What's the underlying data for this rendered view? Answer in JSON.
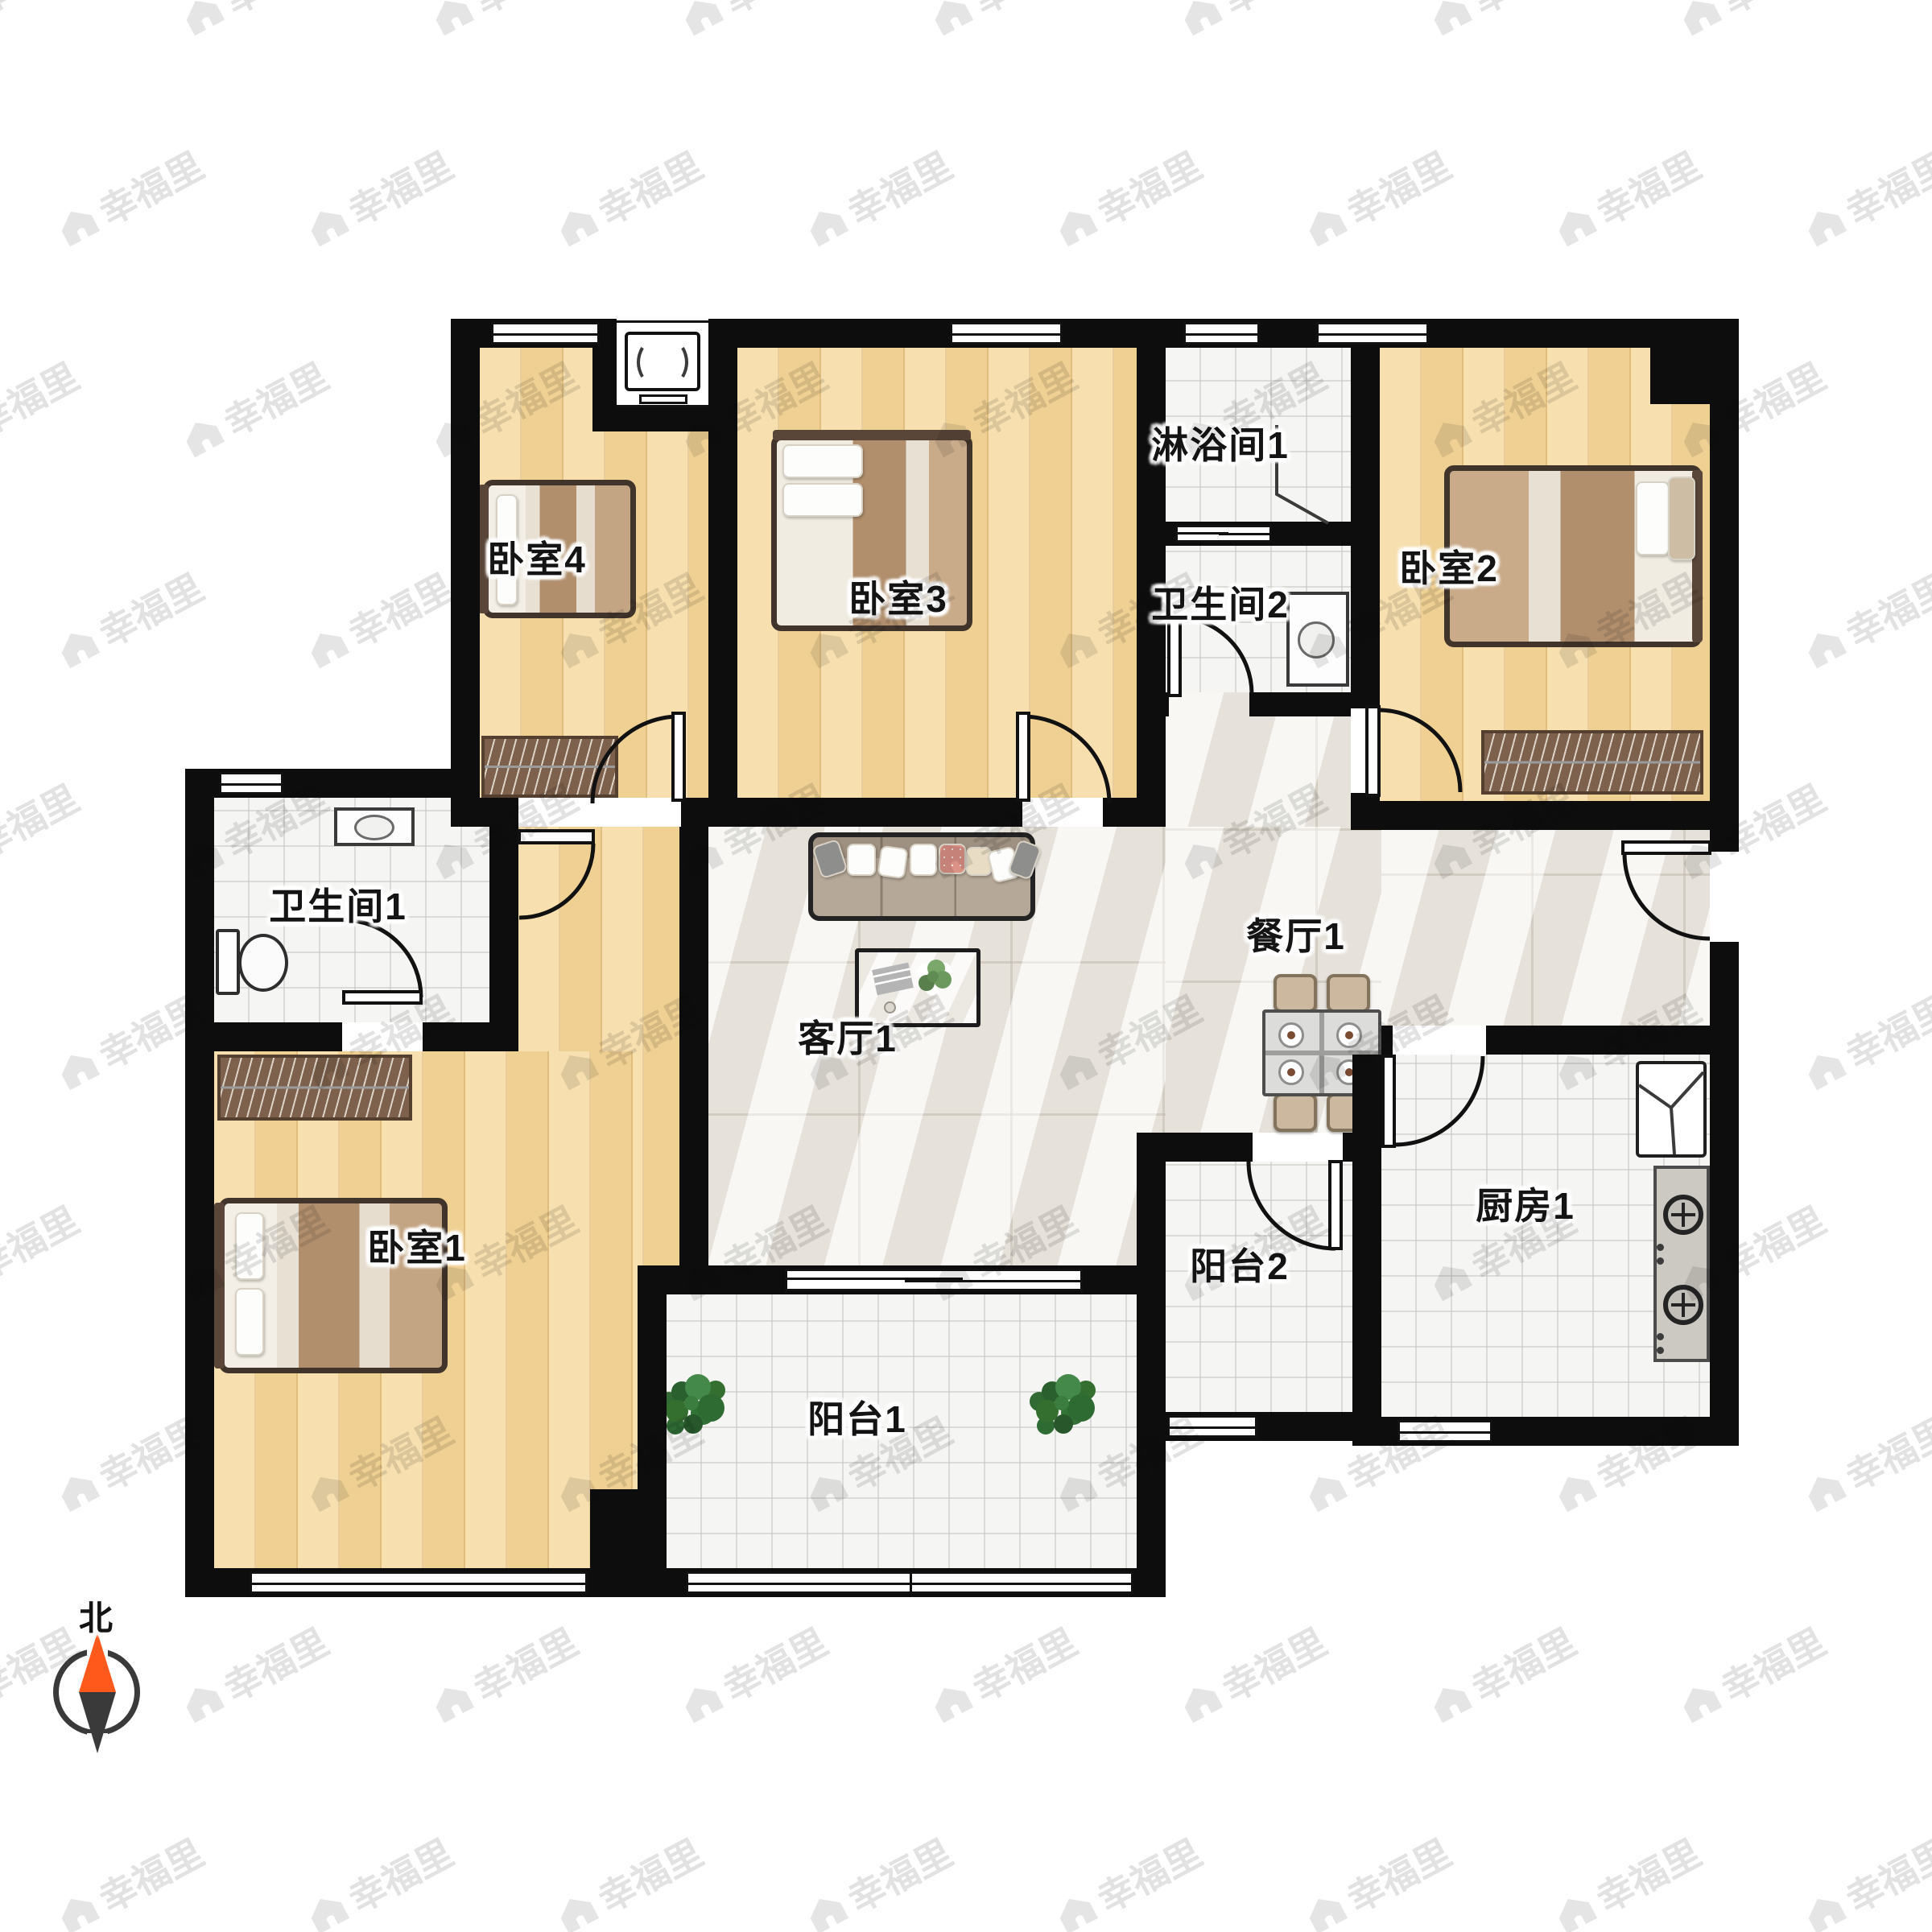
{
  "compass": {
    "north_label": "北"
  },
  "watermark": {
    "text": "幸福里",
    "icon": "house-icon"
  },
  "rooms": [
    {
      "id": "bedroom-4",
      "label": "卧室4"
    },
    {
      "id": "bedroom-3",
      "label": "卧室3"
    },
    {
      "id": "shower-room-1",
      "label": "淋浴间1"
    },
    {
      "id": "bathroom-2",
      "label": "卫生间2"
    },
    {
      "id": "bedroom-2",
      "label": "卧室2"
    },
    {
      "id": "bathroom-1",
      "label": "卫生间1"
    },
    {
      "id": "bedroom-1",
      "label": "卧室1"
    },
    {
      "id": "living-room-1",
      "label": "客厅1"
    },
    {
      "id": "dining-room-1",
      "label": "餐厅1"
    },
    {
      "id": "kitchen-1",
      "label": "厨房1"
    },
    {
      "id": "balcony-2",
      "label": "阳台2"
    },
    {
      "id": "balcony-1",
      "label": "阳台1"
    }
  ],
  "palette": {
    "wall": "#0d0d0d",
    "wood_floor": "#f5d89d",
    "marble_floor": "#f0ede7",
    "tile_floor": "#f5f5f3",
    "north_arrow_orange": "#ff5a1c",
    "north_arrow_dark": "#3a3a3a",
    "label_text": "#141414",
    "watermark_gray": "#7d7d7d"
  },
  "furniture_icons": [
    "double-bed-icon",
    "single-bed-icon",
    "wardrobe-icon",
    "sofa-icon",
    "coffee-table-icon",
    "dining-table-icon",
    "dining-chair-icon",
    "plate-icon",
    "toilet-icon",
    "sink-icon",
    "shower-screen-icon",
    "fridge-icon",
    "gas-stove-icon",
    "air-conditioner-icon",
    "potted-plant-icon",
    "door-icon",
    "window-icon",
    "compass-icon"
  ]
}
